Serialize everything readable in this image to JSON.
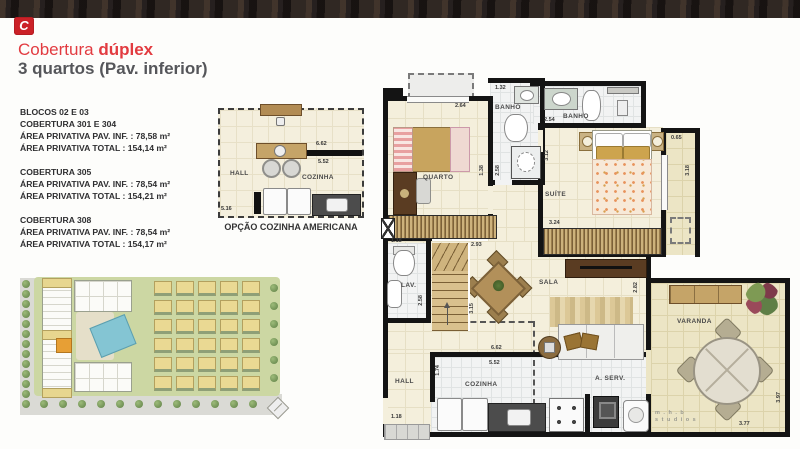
{
  "brand": {
    "logo_glyph": "C"
  },
  "title": {
    "line1_normal": "Cobertura ",
    "line1_bold": "dúplex",
    "line2": "3 quartos (Pav. inferior)"
  },
  "units": {
    "b1": {
      "l1": "BLOCOS 02 E 03",
      "l2": "COBERTURA 301 E  304",
      "l3": "ÁREA PRIVATIVA PAV. INF. :  78,58 m²",
      "l4": "ÁREA PRIVATIVA TOTAL :   154,14 m²"
    },
    "b2": {
      "l1": "COBERTURA 305",
      "l2": "ÁREA PRIVATIVA PAV. INF. :  78,54 m²",
      "l3": "ÁREA PRIVATIVA TOTAL :   154,21 m²"
    },
    "b3": {
      "l1": "COBERTURA 308",
      "l2": "ÁREA PRIVATIVA PAV. INF. :  78,54 m²",
      "l3": "ÁREA PRIVATIVA TOTAL :   154,17 m²"
    }
  },
  "kitchen_option": {
    "caption": "OPÇÃO COZINHA AMERICANA",
    "hall": "HALL",
    "cozinha": "COZINHA",
    "dim_top": "6.62",
    "dim_inner": "5.52",
    "dim_left": "5.16"
  },
  "plan": {
    "rooms": {
      "quarto": "QUARTO",
      "banho1": "BANHO",
      "banho2": "BANHO",
      "suite": "SUÍTE",
      "lav": "LAV.",
      "sala": "SALA",
      "hall": "HALL",
      "cozinha": "COZINHA",
      "aserv": "A. SERV.",
      "varanda": "VARANDA"
    },
    "dims": {
      "quarto_w": "2.64",
      "banho1_w": "1.32",
      "suite_top": "2.54",
      "suite_h": "3.12",
      "ward": "3.24",
      "balc_w": "0.65",
      "balc_h": "3.18",
      "quarto_r": "1.38",
      "corr_h": "2.58",
      "lav_top": "1.18",
      "lav_h": "2.58",
      "stair_w": "2.93",
      "stair_h": "3.15",
      "sala_h": "2.82",
      "kitchen_w": "6.62",
      "kitchen_w2": "5.52",
      "hall_h": "1.74",
      "entry": "1.18",
      "var_w": "3.77",
      "var_h": "3.97"
    },
    "watermark_line1": "m . h . b",
    "watermark_line2": "s t u d i o s"
  },
  "colors": {
    "accent_red": "#cb2127",
    "title_red": "#e23b40",
    "subtitle_gray": "#55565a",
    "wall_black": "#141414"
  }
}
